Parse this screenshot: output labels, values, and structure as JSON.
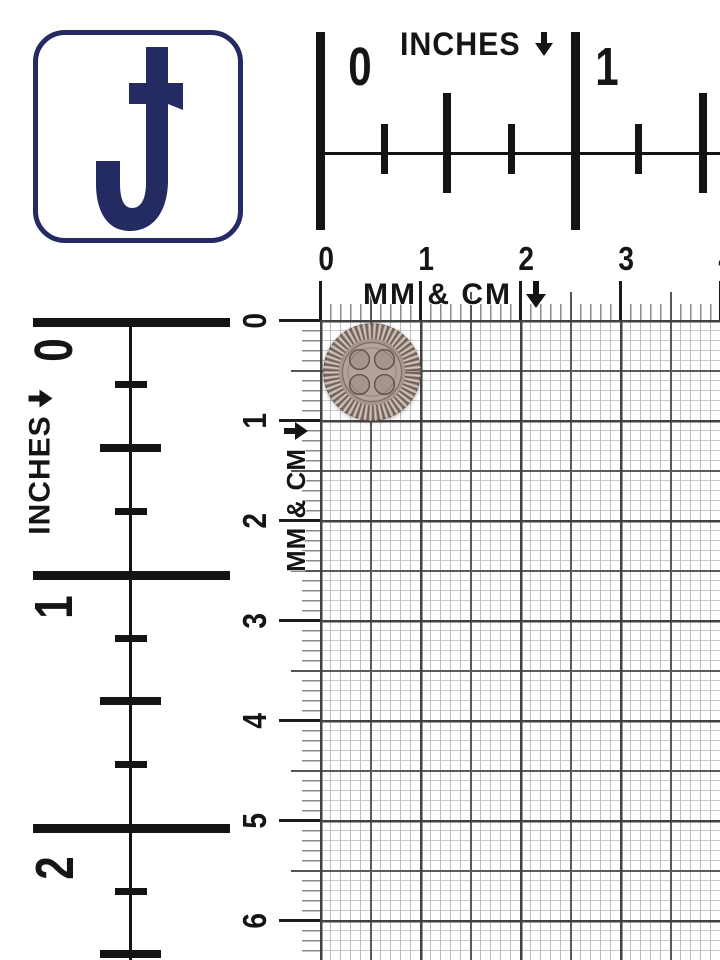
{
  "colors": {
    "navy": "#242b63",
    "ink": "#151515",
    "grid_major_line": "#414141",
    "grid_minor_line": "#bdbdbd",
    "button_base": "#a4958d",
    "button_face": "#b2a39b",
    "button_groove": "#6e5f58",
    "button_ridge": "#d2c4bc"
  },
  "logo": {
    "letter": "J"
  },
  "icons": {
    "down_arrow": "↓"
  },
  "rulers": {
    "top_inch": {
      "label": "INCHES",
      "numbers": [
        "0",
        "1"
      ]
    },
    "top_metric": {
      "label": "MM & CM",
      "numbers": [
        "0",
        "1",
        "2",
        "3",
        "4"
      ]
    },
    "left_inch": {
      "label": "INCHES",
      "numbers": [
        "0",
        "1",
        "2"
      ]
    },
    "left_metric": {
      "label": "MM & CM",
      "numbers": [
        "0",
        "1",
        "2",
        "3",
        "4",
        "5",
        "6"
      ]
    }
  },
  "subject": {
    "name": "four-hole sewing button",
    "holes": 4,
    "size_cm": "1.0"
  }
}
